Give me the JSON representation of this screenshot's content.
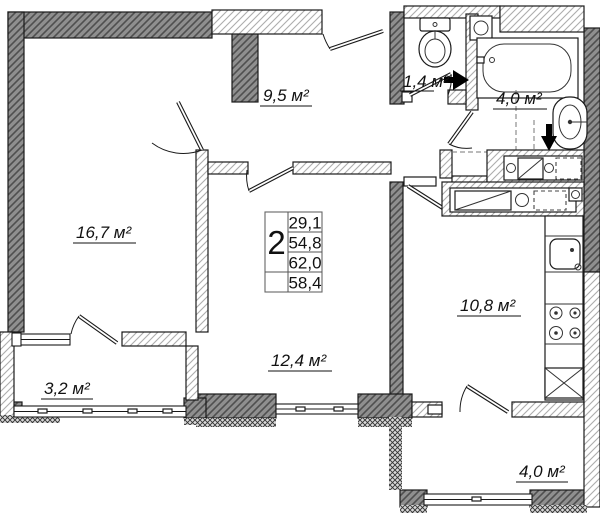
{
  "plan_type": "apartment-floor-plan",
  "colors": {
    "wall_dark_fill": "#8f8f8f",
    "wall_dark_hatch": "#4f4f4f",
    "wall_light_hatch": "#adadad",
    "outline": "#1a1a1a",
    "arrow": "#000000"
  },
  "rooms": {
    "living": {
      "area": "16,7 м²"
    },
    "hall": {
      "area": "9,5 м²"
    },
    "wc": {
      "area": "1,4 м²"
    },
    "bathroom": {
      "area": "4,0 м²"
    },
    "kitchen": {
      "area": "10,8 м²"
    },
    "bedroom": {
      "area": "12,4 м²"
    },
    "balcony_left": {
      "area": "3,2 м²"
    },
    "balcony_right": {
      "area": "4,0 м²"
    }
  },
  "summary_table": {
    "rooms_count": "2",
    "values": [
      "29,1",
      "54,8",
      "62,0",
      "58,4"
    ]
  }
}
